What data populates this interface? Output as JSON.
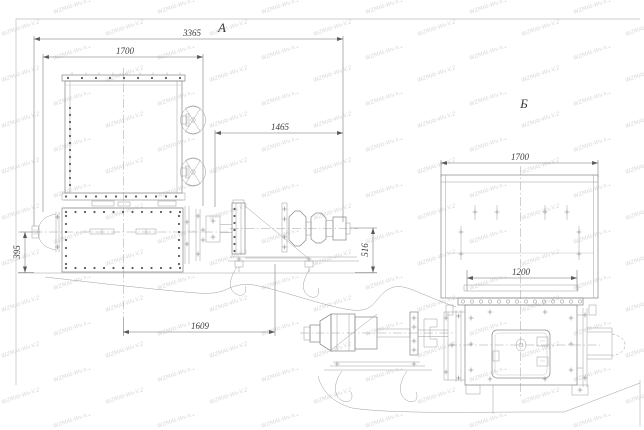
{
  "sheet": {
    "watermark_text": "WZMAt-Wv.V.2"
  },
  "views": {
    "a": {
      "label": "A",
      "dims": {
        "total_length": "3365",
        "housing_width": "1700",
        "drive_span": "1465",
        "base_span": "1609",
        "axis_height": "395",
        "drive_axis_height": "516"
      }
    },
    "b": {
      "label": "Б",
      "dims": {
        "housing_width": "1700",
        "opening_width": "1200"
      }
    }
  },
  "colors": {
    "line": "#8d8d8d",
    "dim_text": "#3c3c3c",
    "watermark": "#d8d8d8"
  }
}
